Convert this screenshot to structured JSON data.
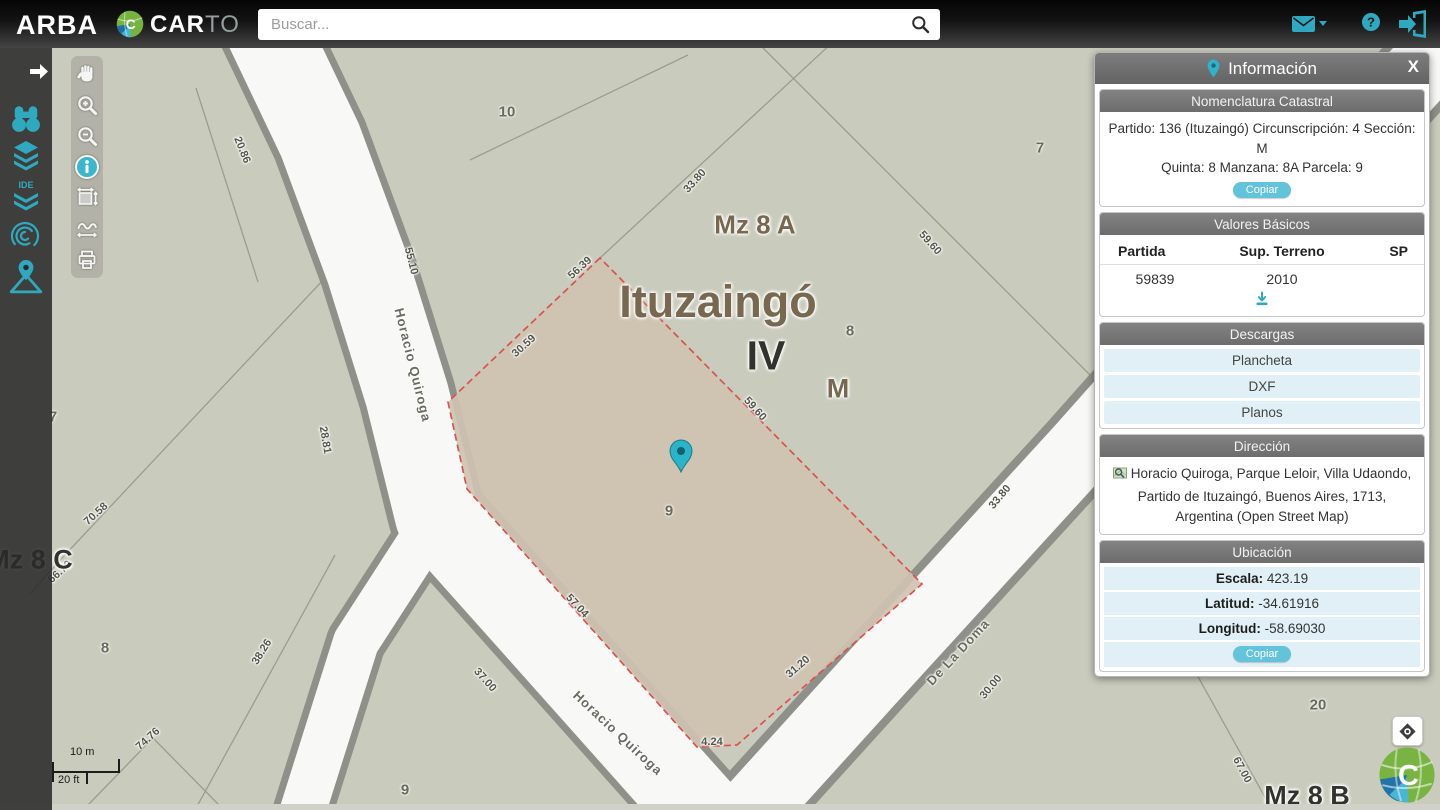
{
  "colors": {
    "accent": "#2fa9c0",
    "panel_header": "#6f6f6f",
    "map_bg": "#c9cbbc",
    "road_fill": "#f8f8f6",
    "road_casing": "#8f9089",
    "parcel_fill": "#cfc3b1",
    "parcel_border": "#d9534f"
  },
  "header": {
    "brand": "ARBA",
    "carto_bold": "CAR",
    "carto_light": "TO",
    "search_placeholder": "Buscar..."
  },
  "panel": {
    "title": "Información",
    "close": "X",
    "nomenclatura": {
      "header": "Nomenclatura Catastral",
      "line1": "Partido: 136 (Ituzaingó) Circunscripción: 4 Sección: M",
      "line2": "Quinta: 8 Manzana: 8A Parcela: 9",
      "copy_label": "Copiar"
    },
    "valores": {
      "header": "Valores Básicos",
      "col1": "Partida",
      "col2": "Sup. Terreno",
      "col3": "SP",
      "partida": "59839",
      "sup_terreno": "2010",
      "sp": ""
    },
    "descargas": {
      "header": "Descargas",
      "items": [
        "Plancheta",
        "DXF",
        "Planos"
      ]
    },
    "direccion": {
      "header": "Dirección",
      "text": "Horacio Quiroga, Parque Leloir, Villa Udaondo, Partido de Ituzaingó, Buenos Aires, 1713, Argentina (Open Street Map)"
    },
    "ubicacion": {
      "header": "Ubicación",
      "escala_label": "Escala:",
      "escala": " 423.19",
      "latitud_label": "Latitud:",
      "latitud": " -34.61916",
      "longitud_label": "Longitud:",
      "longitud": " -58.69030",
      "copy_label": "Copiar"
    }
  },
  "sidebar": {
    "ide_label": "IDE"
  },
  "map": {
    "place_labels": [
      {
        "text": "Mz 8 A"
      },
      {
        "text": "Ituzaingó"
      },
      {
        "text": "IV"
      },
      {
        "text": "M"
      },
      {
        "text": "Mz 8 C"
      },
      {
        "text": "Mz 8 B"
      }
    ],
    "streets": [
      {
        "text": "Horacio Quiroga"
      },
      {
        "text": "Horacio Quiroga"
      },
      {
        "text": "De La Doma"
      }
    ],
    "measurements": [
      {
        "text": "20.86"
      },
      {
        "text": "55.10"
      },
      {
        "text": "56.39"
      },
      {
        "text": "30.59"
      },
      {
        "text": "33.80"
      },
      {
        "text": "59.60"
      },
      {
        "text": "59.60"
      },
      {
        "text": "28.81"
      },
      {
        "text": "70.58"
      },
      {
        "text": "66.70"
      },
      {
        "text": "38.26"
      },
      {
        "text": "74.76"
      },
      {
        "text": "37.00"
      },
      {
        "text": "57.04"
      },
      {
        "text": "4.24"
      },
      {
        "text": "31.20"
      },
      {
        "text": "33.80"
      },
      {
        "text": "30.00"
      },
      {
        "text": "67.00"
      }
    ],
    "parcel_numbers": [
      {
        "text": "10"
      },
      {
        "text": "7"
      },
      {
        "text": "8"
      },
      {
        "text": "9"
      },
      {
        "text": "7"
      },
      {
        "text": "8"
      },
      {
        "text": "20"
      },
      {
        "text": "9"
      }
    ],
    "scale": {
      "metric": "10 m",
      "imperial": "20 ft"
    }
  }
}
